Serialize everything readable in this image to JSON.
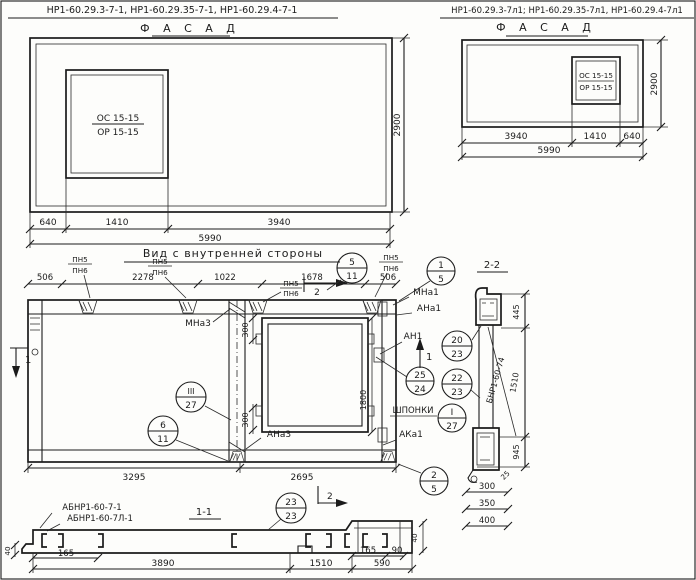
{
  "header_left": {
    "codes": "НР1-60.29.3-7-1,  НР1-60.29.35-7-1,  НР1-60.29.4-7-1",
    "title": "Ф А С А Д"
  },
  "header_right": {
    "codes": "НР1-60.29.3-7л1; НР1-60.29.35-7л1, НР1-60.29.4-7л1",
    "title": "Ф А С А Д"
  },
  "window_mark": {
    "top": "ОС 15-15",
    "bottom": "ОР 15-15"
  },
  "facade_left": {
    "d1": "640",
    "d2": "1410",
    "d3": "3940",
    "total": "5990",
    "height": "2900"
  },
  "facade_right": {
    "d1": "3940",
    "d2": "1410",
    "d3": "640",
    "total": "5990",
    "height": "2900"
  },
  "inner_view": {
    "title": "Вид с внутренней стороны",
    "pn5": "ПН5",
    "pn6": "ПН6",
    "top_dims": [
      "506",
      "2278",
      "1022",
      "1678",
      "506"
    ],
    "bottom_dims": [
      "3295",
      "2695"
    ],
    "dim300": "300",
    "dim1800": "1800",
    "labels": {
      "mna3": "МНа3",
      "ana3": "АНа3",
      "mna1": "МНа1",
      "ana1": "АНа1",
      "an1": "АН1",
      "aka1": "АКа1",
      "shponki": "ШПОНКИ"
    }
  },
  "section2": {
    "title": "2-2",
    "d445": "445",
    "d1510": "1510",
    "d945": "945",
    "d25": "25",
    "note": "БНР1-60-74",
    "stack": [
      "300",
      "350",
      "400"
    ]
  },
  "section1": {
    "title": "1-1",
    "code1": "АБНР1-60-7-1",
    "code2": "АБНР1-60-7Л-1",
    "d40": "40",
    "d165": "165",
    "d3890": "3890",
    "d1510": "1510",
    "d590": "590",
    "d90": "90"
  },
  "markers": {
    "m1": "1",
    "m2": "2"
  },
  "balloons": {
    "b5_11": {
      "num": "5",
      "den": "11"
    },
    "b1_5": {
      "num": "1",
      "den": "5"
    },
    "b20_23": {
      "num": "20",
      "den": "23"
    },
    "b22_23": {
      "num": "22",
      "den": "23"
    },
    "b25_24": {
      "num": "25",
      "den": "24"
    },
    "b3_27": {
      "num": "III",
      "den": "27"
    },
    "bI_27": {
      "num": "I",
      "den": "27"
    },
    "b6_11": {
      "num": "6",
      "den": "11"
    },
    "b2_5": {
      "num": "2",
      "den": "5"
    },
    "b23_23": {
      "num": "23",
      "den": "23"
    }
  }
}
